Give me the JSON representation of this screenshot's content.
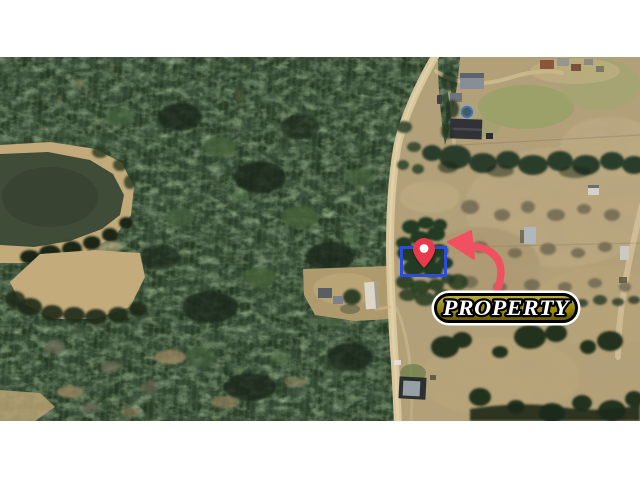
{
  "badge": {
    "label": "PROPERTY"
  },
  "colors": {
    "background": "#ffffff",
    "boundary_blue": "#2a4ce0",
    "pin_red": "#e93a4d",
    "pin_dot": "#ffffff",
    "arrow_red": "#f0505f",
    "badge_gold": "#9c8b05",
    "badge_border": "#000000",
    "badge_ring": "#ffffff",
    "badge_text": "#ffffff"
  }
}
